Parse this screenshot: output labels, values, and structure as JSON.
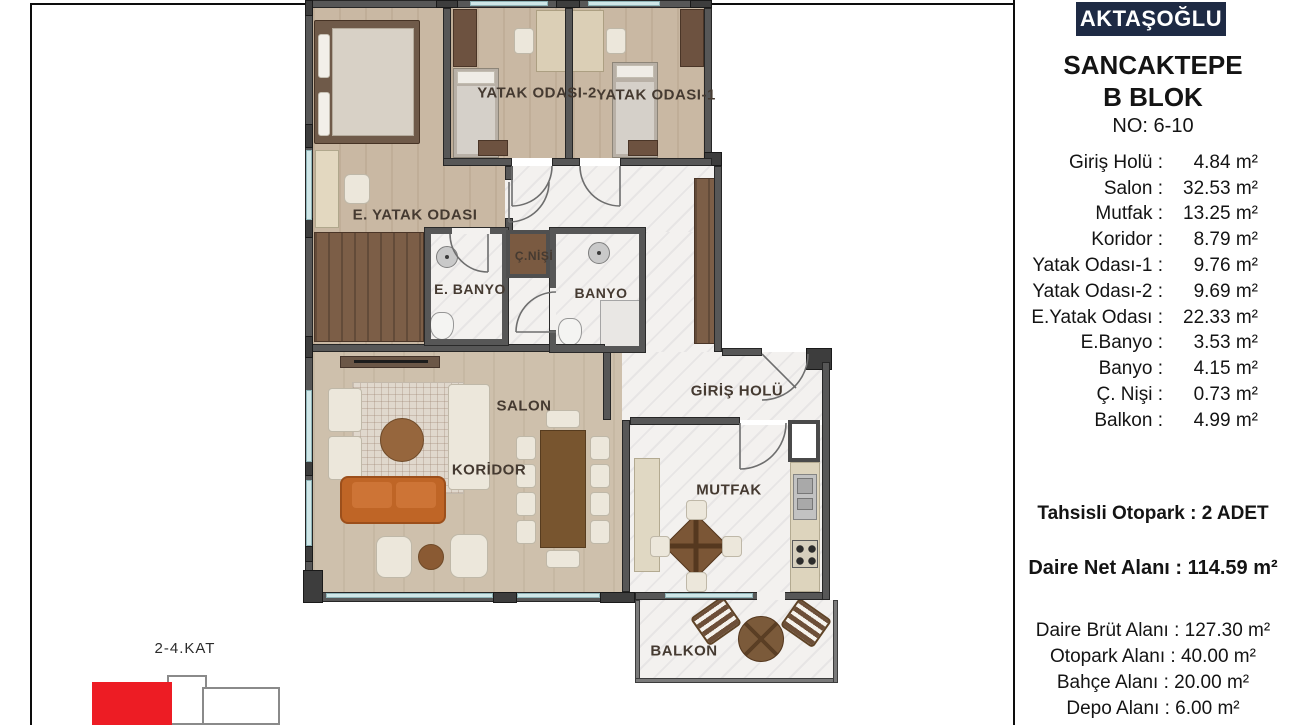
{
  "header": {
    "brand": "AKTAŞOĞLU",
    "project": "SANCAKTEPE",
    "block": "B BLOK",
    "unit_no": "NO: 6-10"
  },
  "room_areas": [
    {
      "label": "Giriş Holü :",
      "value": "4.84 m²"
    },
    {
      "label": "Salon :",
      "value": "32.53 m²"
    },
    {
      "label": "Mutfak :",
      "value": "13.25 m²"
    },
    {
      "label": "Koridor :",
      "value": "8.79 m²"
    },
    {
      "label": "Yatak Odası-1 :",
      "value": "9.76 m²"
    },
    {
      "label": "Yatak Odası-2 :",
      "value": "9.69 m²"
    },
    {
      "label": "E.Yatak Odası :",
      "value": "22.33 m²"
    },
    {
      "label": "E.Banyo :",
      "value": "3.53 m²"
    },
    {
      "label": "Banyo :",
      "value": "4.15 m²"
    },
    {
      "label": "Ç. Nişi :",
      "value": "0.73 m²"
    },
    {
      "label": "Balkon :",
      "value": "4.99 m²"
    }
  ],
  "parking_line": "Tahsisli Otopark : 2 ADET",
  "net_area_line": "Daire Net Alanı : 114.59 m²",
  "extra_lines": [
    "Daire Brüt Alanı : 127.30 m²",
    "Otopark Alanı : 40.00 m²",
    "Bahçe Alanı : 20.00 m²",
    "Depo Alanı : 6.00 m²"
  ],
  "floor_key": {
    "label": "2-4.KAT"
  },
  "plan_labels": {
    "yatak2": "YATAK ODASI-2",
    "yatak1": "YATAK ODASI-1",
    "eyatak": "E. YATAK ODASI",
    "nisi": "Ç.NİŞİ",
    "ebanyo": "E. BANYO",
    "banyo": "BANYO",
    "giris": "GİRİŞ HOLÜ",
    "salon": "SALON",
    "koridor": "KORİDOR",
    "mutfak": "MUTFAK",
    "balkon": "BALKON"
  },
  "colors": {
    "brand_navy": "#1e2a44",
    "key_red": "#ed1c24",
    "wall_gray": "#575757",
    "wood_floor": "#c9b8a3",
    "marble_floor": "#f3f1ef",
    "window_blue": "#cfe6e7"
  }
}
